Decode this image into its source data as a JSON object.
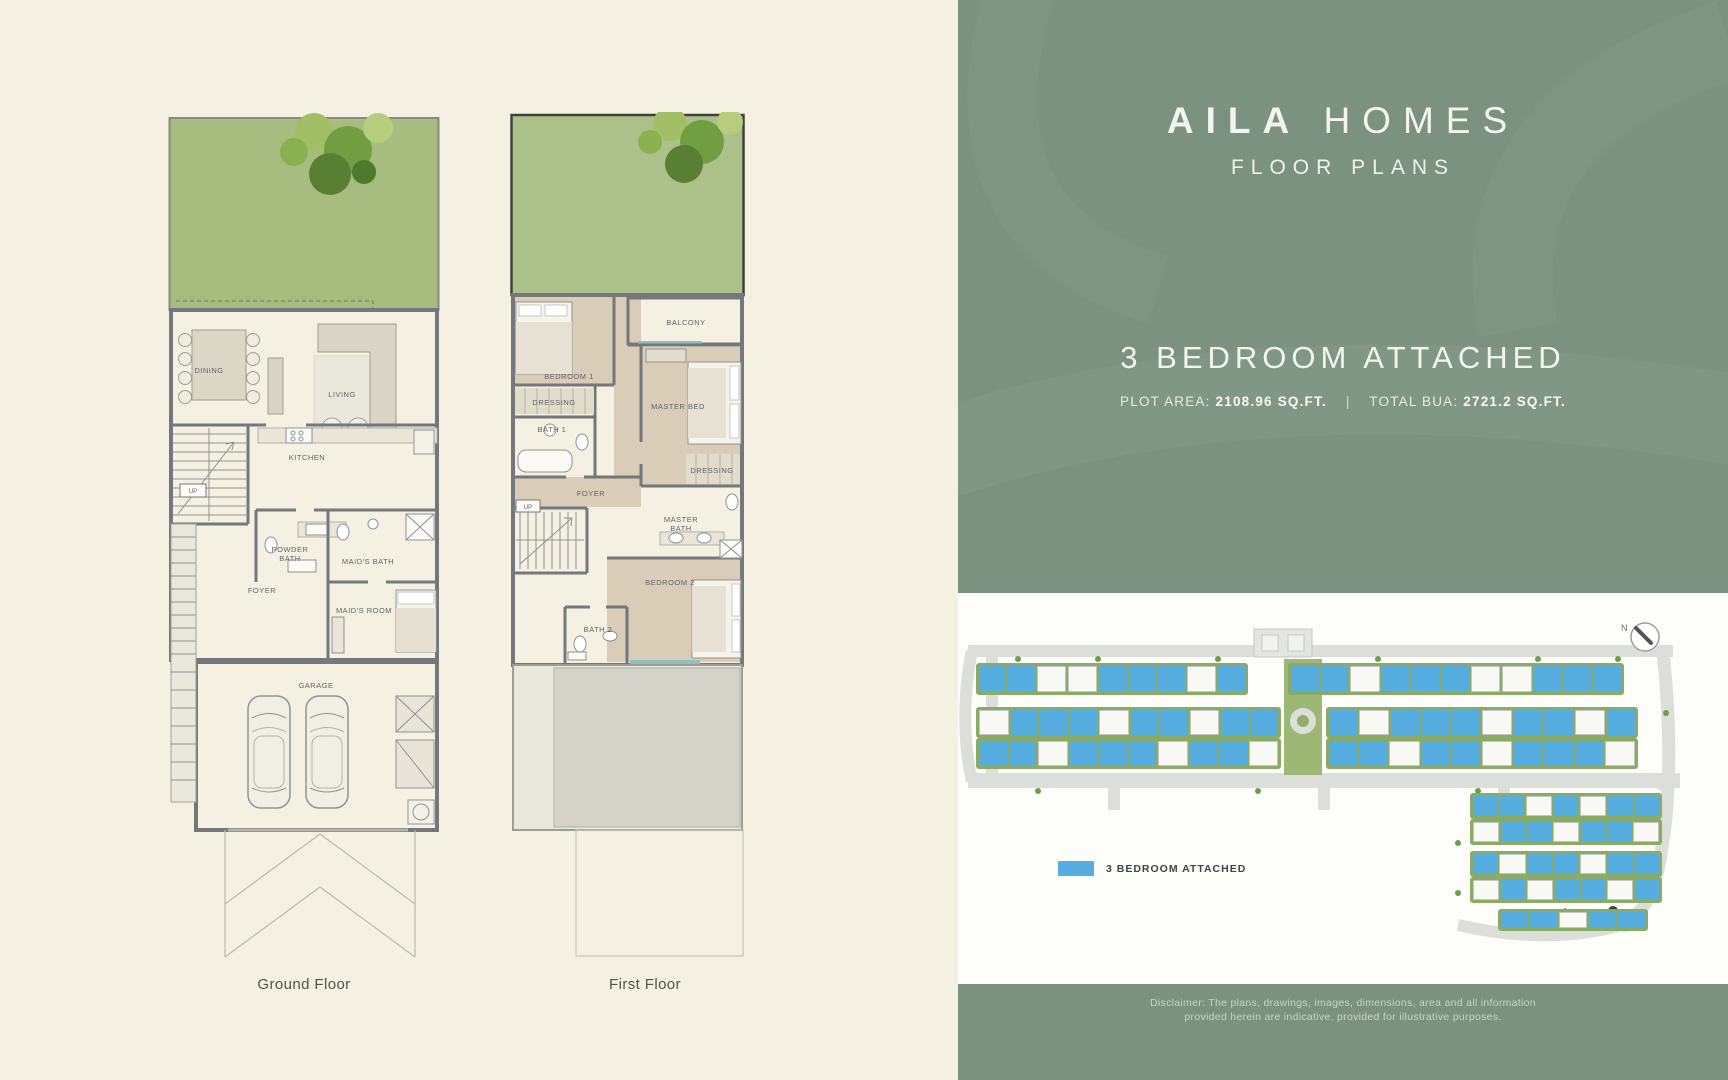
{
  "brand": {
    "title_primary": "AILA",
    "title_secondary": "HOMES",
    "subtitle": "FLOOR PLANS"
  },
  "unit": {
    "title": "3 BEDROOM ATTACHED",
    "plot_area_label": "PLOT AREA:",
    "plot_area_value": "2108.96 SQ.FT.",
    "divider": "|",
    "bua_label": "TOTAL BUA:",
    "bua_value": "2721.2 SQ.FT."
  },
  "plans": {
    "ground": {
      "caption": "Ground Floor",
      "labels": {
        "dining": "DINING",
        "living": "LIVING",
        "kitchen": "KITCHEN",
        "powder_bath": [
          "POWDER",
          "BATH"
        ],
        "maids_bath": "MAID'S BATH",
        "foyer": "FOYER",
        "maids_room": "MAID'S ROOM",
        "garage": "GARAGE",
        "up": "UP"
      }
    },
    "first": {
      "caption": "First Floor",
      "labels": {
        "bedroom1": "BEDROOM 1",
        "dressing1": "DRESSING",
        "bath1": "BATH 1",
        "balcony": "BALCONY",
        "master_bed": "MASTER BED",
        "dressing2": "DRESSING",
        "foyer": "FOYER",
        "master_bath": [
          "MASTER",
          "BATH"
        ],
        "bedroom2": "BEDROOM 2",
        "bath2": "BATH 2",
        "up": "UP"
      }
    }
  },
  "sitemap": {
    "legend_label": "3 BEDROOM ATTACHED",
    "legend_color": "#56aee0",
    "compass_label": "N",
    "unit_colors": {
      "b": "#56aee0",
      "w": "#f8f8f5"
    },
    "rows": [
      {
        "x": 18,
        "y": 70,
        "w": 272,
        "h": 32,
        "cells": [
          "b",
          "b",
          "w",
          "w",
          "b",
          "b",
          "b",
          "w",
          "b"
        ]
      },
      {
        "x": 330,
        "y": 70,
        "w": 336,
        "h": 32,
        "cells": [
          "b",
          "b",
          "w",
          "b",
          "b",
          "b",
          "w",
          "w",
          "b",
          "b",
          "b"
        ]
      },
      {
        "x": 18,
        "y": 114,
        "w": 305,
        "h": 31,
        "cells": [
          "w",
          "b",
          "b",
          "b",
          "w",
          "b",
          "b",
          "w",
          "b",
          "b"
        ]
      },
      {
        "x": 368,
        "y": 114,
        "w": 312,
        "h": 31,
        "cells": [
          "b",
          "w",
          "b",
          "b",
          "b",
          "w",
          "b",
          "b",
          "w",
          "b"
        ]
      },
      {
        "x": 18,
        "y": 145,
        "w": 305,
        "h": 31,
        "cells": [
          "b",
          "b",
          "w",
          "b",
          "b",
          "b",
          "w",
          "b",
          "b",
          "w"
        ]
      },
      {
        "x": 368,
        "y": 145,
        "w": 312,
        "h": 31,
        "cells": [
          "b",
          "b",
          "w",
          "b",
          "b",
          "w",
          "b",
          "b",
          "b",
          "w"
        ]
      },
      {
        "x": 512,
        "y": 200,
        "w": 192,
        "h": 26,
        "cells": [
          "b",
          "b",
          "w",
          "b",
          "w",
          "b",
          "b"
        ]
      },
      {
        "x": 512,
        "y": 226,
        "w": 192,
        "h": 26,
        "cells": [
          "w",
          "b",
          "b",
          "w",
          "b",
          "b",
          "w"
        ]
      },
      {
        "x": 512,
        "y": 258,
        "w": 192,
        "h": 26,
        "cells": [
          "b",
          "w",
          "b",
          "b",
          "w",
          "b",
          "b"
        ]
      },
      {
        "x": 512,
        "y": 284,
        "w": 192,
        "h": 26,
        "cells": [
          "w",
          "b",
          "w",
          "b",
          "b",
          "w",
          "b"
        ]
      },
      {
        "x": 540,
        "y": 316,
        "w": 150,
        "h": 22,
        "cells": [
          "b",
          "b",
          "w",
          "b",
          "b"
        ]
      }
    ]
  },
  "disclaimer": {
    "line1": "Disclaimer: The plans, drawings, images, dimensions, area and all information",
    "line2": "provided herein are indicative, provided for illustrative purposes."
  },
  "colors": {
    "left_bg": "#f4f1e2",
    "right_bg": "#7a927f",
    "panel_bg": "#fdfdfa",
    "garden_green": "#a6bd7f",
    "accent_blue": "#56aee0"
  }
}
